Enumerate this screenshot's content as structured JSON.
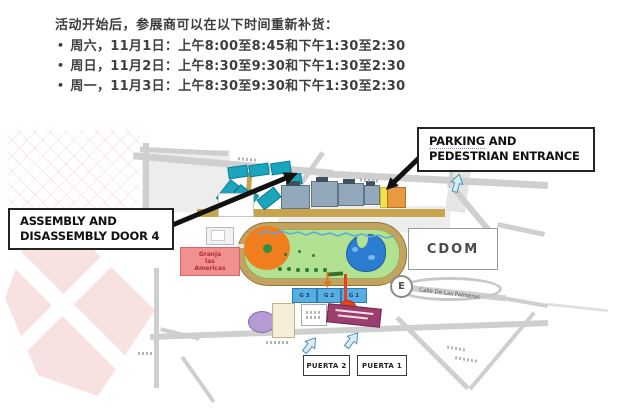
{
  "notice": {
    "bullet": "•",
    "title": "活动开始后，参展商可以在以下时间重新补货：",
    "items": [
      "周六，11月1日：上午8:00至8:45和下午1:30至2:30",
      "周日，11月2日：上午8:30至9:30和下午1:30至2:30",
      "周一，11月3日：上午8:30至9:30和下午1:30至2:30"
    ]
  },
  "map": {
    "callouts": {
      "assembly": {
        "line1": "ASSEMBLY AND",
        "line2": "DISASSEMBLY DOOR 4"
      },
      "parking": {
        "word1": "PARKING",
        "line1_rest": " AND",
        "line2": "PEDESTRIAN ENTRANCE"
      }
    },
    "labels": {
      "cdom": "CDOM",
      "e_sign": "E",
      "granja": [
        "Granja",
        "las",
        "Americas"
      ],
      "street_palmeras": "Calle De Las Palmeras",
      "gates": [
        "G 3",
        "G 2",
        "G 1"
      ],
      "puerta2": "PUERTA 2",
      "puerta1": "PUERTA 1"
    },
    "colors": {
      "exhibit_hall_teal": "#1aa5bd",
      "grandstand_gray": "#93a9bb",
      "entrance_orange": "#e89a42",
      "entrance_yellow": "#f0e24e",
      "track_ring_tan": "#c3a35f",
      "infield_green": "#b2e191",
      "ring_orange": "#f07d1e",
      "lake_blue": "#2b7dd1",
      "granja_pink": "#f29090",
      "gate_blue": "#57aee3",
      "marker_red": "#e8431c",
      "building_magenta": "#9c3f6f",
      "building_purple": "#b49bd6"
    }
  }
}
